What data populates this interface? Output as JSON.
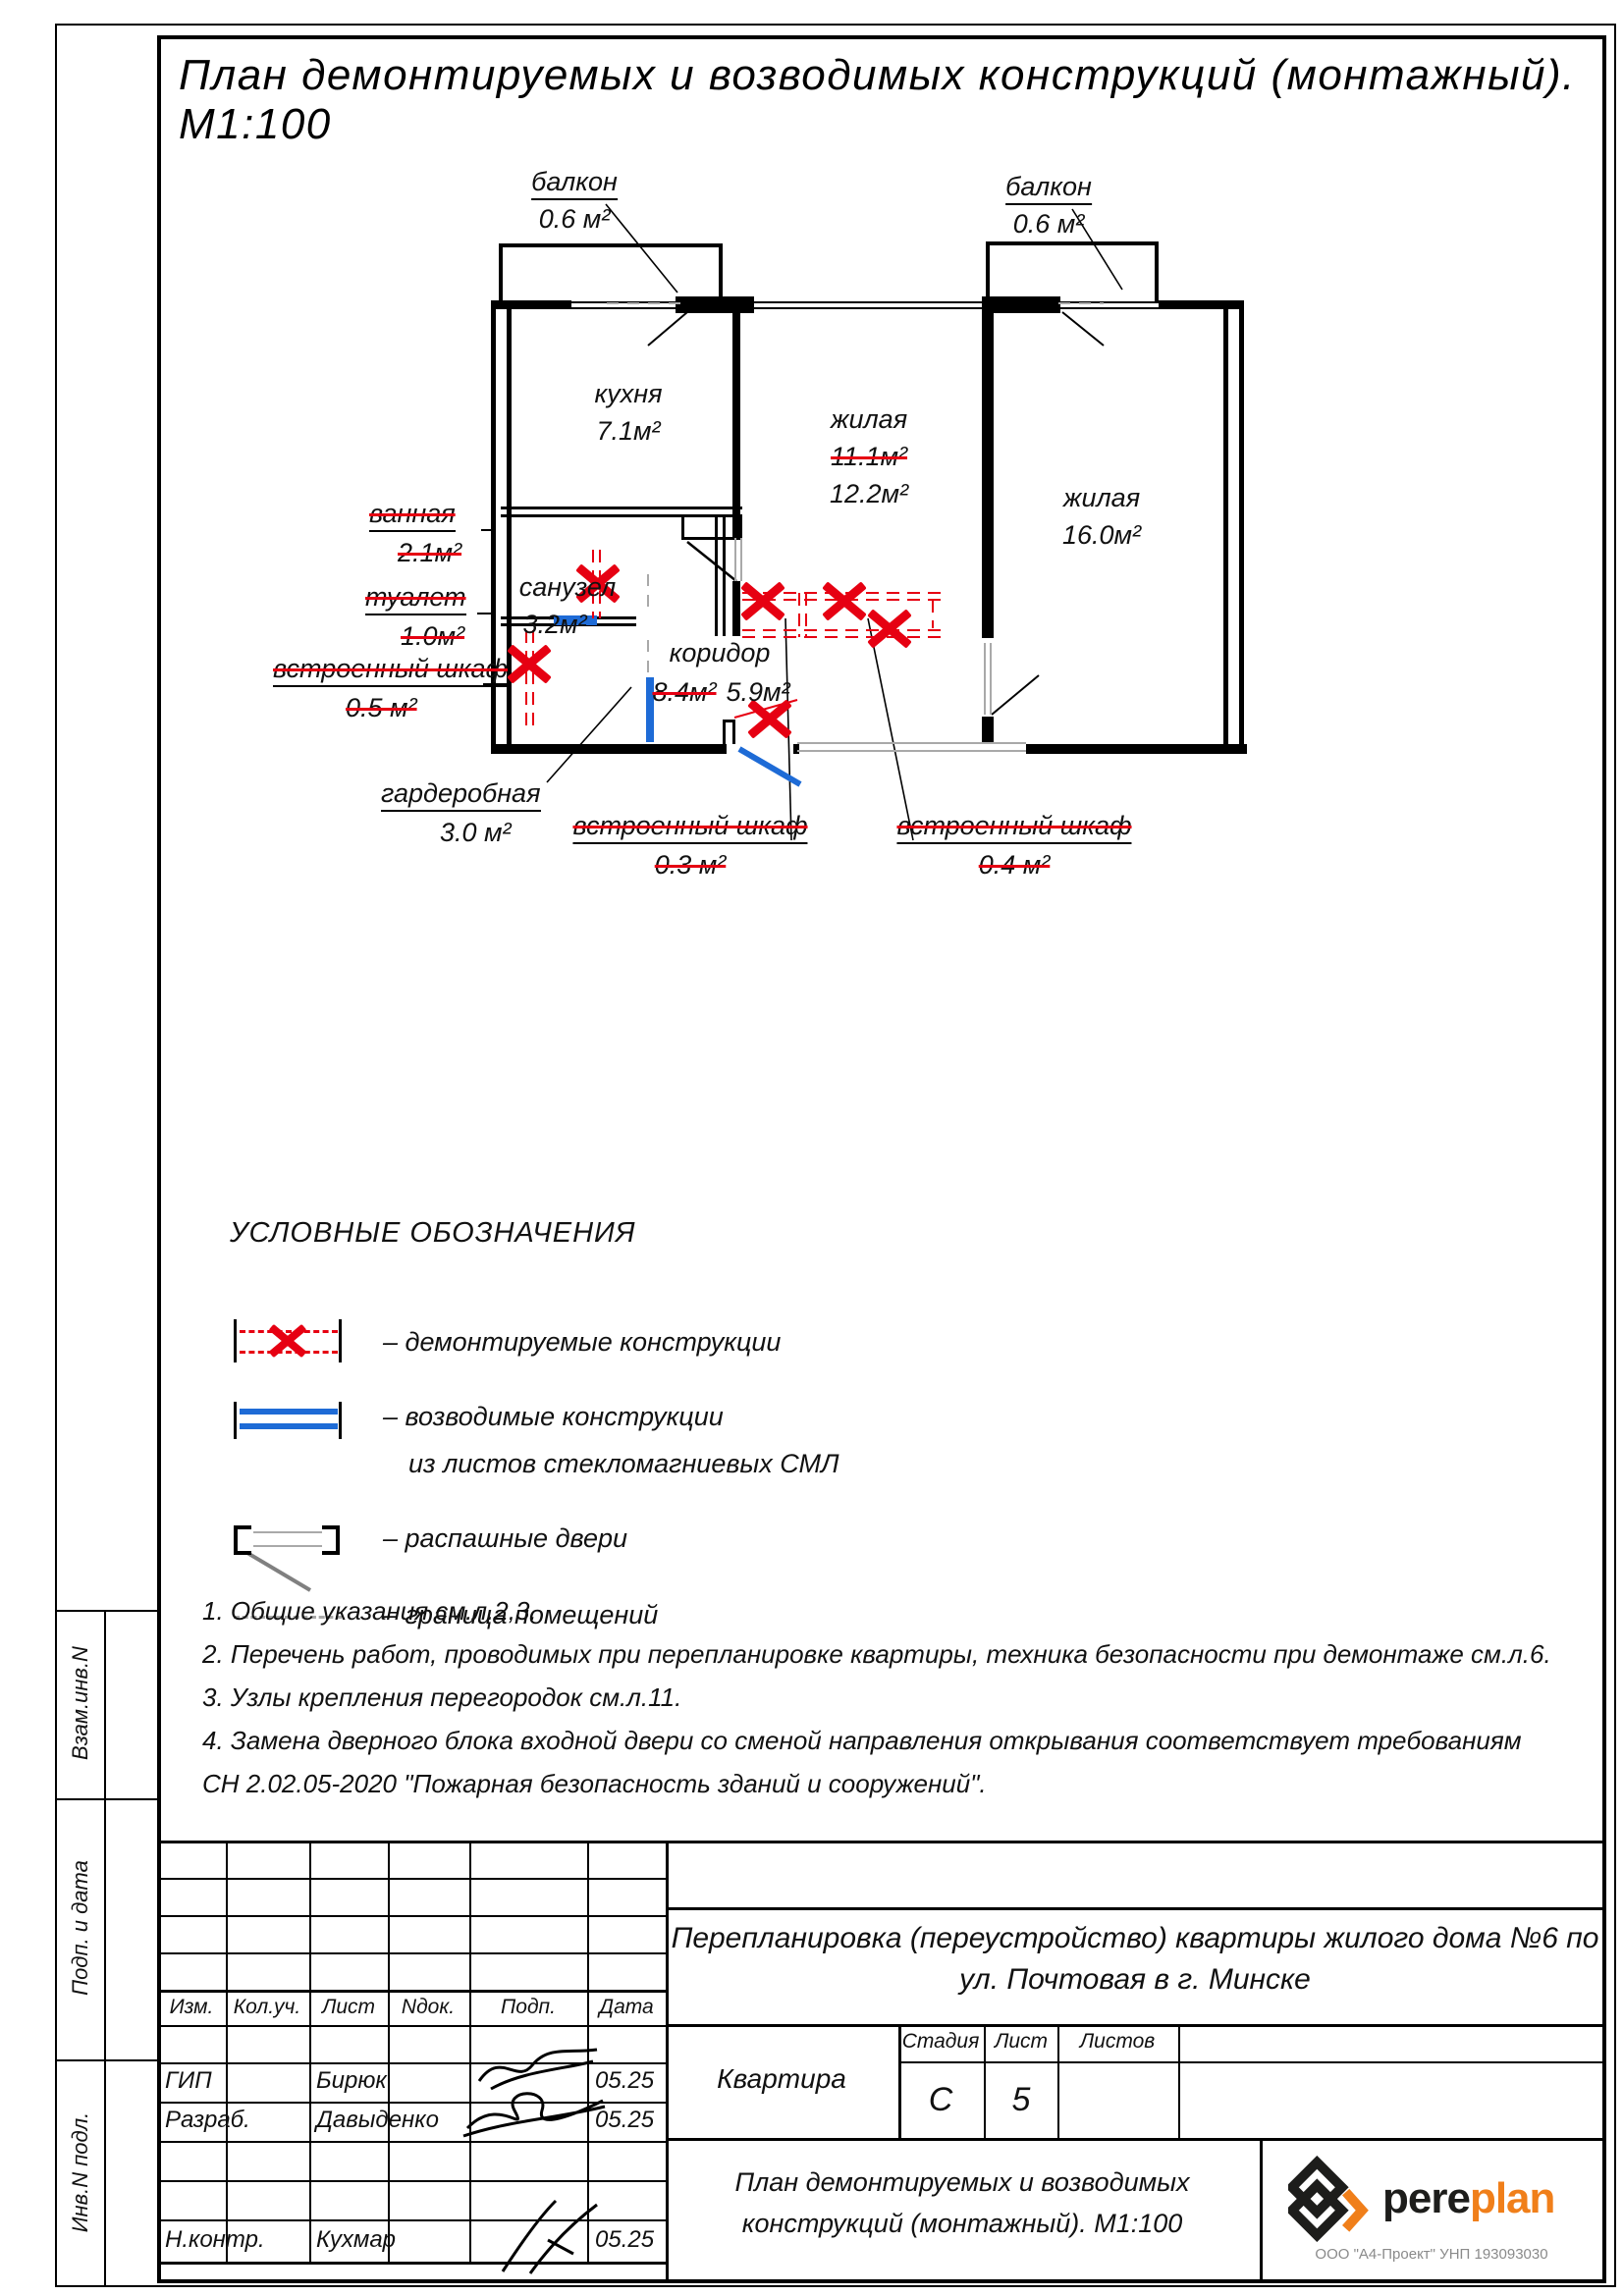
{
  "sheet": {
    "title": "План демонтируемых и возводимых конструкций (монтажный). М1:100"
  },
  "plan": {
    "balcony_left_name": "балкон",
    "balcony_left_area": "0.6 м²",
    "balcony_right_name": "балкон",
    "balcony_right_area": "0.6 м²",
    "kitchen_name": "кухня",
    "kitchen_area": "7.1м²",
    "living1_name": "жилая",
    "living1_area_old": "11.1м²",
    "living1_area_new": "12.2м²",
    "living2_name": "жилая",
    "living2_area": "16.0м²",
    "bathroom_name": "ванная",
    "bathroom_area": "2.1м²",
    "sanuzel_name": "санузел",
    "sanuzel_area": "3.2м²",
    "toilet_name": "туалет",
    "toilet_area": "1.0м²",
    "closet_left_name": "встроенный шкаф",
    "closet_left_area": "0.5 м²",
    "wardrobe_name": "гардеробная",
    "wardrobe_area": "3.0 м²",
    "corridor_name": "коридор",
    "corridor_area_old": "8.4м²",
    "corridor_area_new": "5.9м²",
    "closet1_name": "встроенный шкаф",
    "closet1_area": "0.3 м²",
    "closet2_name": "встроенный шкаф",
    "closet2_area": "0.4 м²"
  },
  "legend": {
    "heading": "УСЛОВНЫЕ ОБОЗНАЧЕНИЯ",
    "item1": "– демонтируемые конструкции",
    "item2a": "– возводимые конструкции",
    "item2b": "из листов стекломагниевых СМЛ",
    "item3": "– распашные двери",
    "item4": "– граница помещений"
  },
  "notes": {
    "n1": "1. Общие указания см.л.2,3.",
    "n2": "2. Перечень работ, проводимых при перепланировке квартиры, техника безопасности при демонтаже см.л.6.",
    "n3": "3. Узлы крепления перегородок см.л.11.",
    "n4": "4. Замена дверного блока входной двери со сменой направления открывания соответствует требованиям",
    "n5": "СН 2.02.05-2020 \"Пожарная безопасность зданий и сооружений\"."
  },
  "sidebar": {
    "box1": "Взам.инв.N",
    "box2": "Подп. и дата",
    "box3": "Инв.N подл."
  },
  "stamp": {
    "col_izm": "Изм.",
    "col_koluch": "Кол.уч.",
    "col_list": "Лист",
    "col_ndok": "Nдок.",
    "col_podp": "Подп.",
    "col_data": "Дата",
    "row1_role": "ГИП",
    "row1_name": "Бирюк",
    "row1_date": "05.25",
    "row2_role": "Разраб.",
    "row2_name": "Давыденко",
    "row2_date": "05.25",
    "row3_role": "Н.контр.",
    "row3_name": "Кухмар",
    "row3_date": "05.25",
    "project_line1": "Перепланировка (переустройство) квартиры жилого дома №6 по",
    "project_line2": "ул. Почтовая в г. Минске",
    "object": "Квартира",
    "stage_label": "Стадия",
    "sheet_label": "Лист",
    "sheets_label": "Листов",
    "stage_value": "С",
    "sheet_value": "5",
    "doc_title_line1": "План демонтируемых и возводимых",
    "doc_title_line2": "конструкций (монтажный). М1:100",
    "logo_part1": "pere",
    "logo_part2": "plan",
    "company": "ООО \"А4-Проект\" УНП 193093030"
  },
  "colors": {
    "demolition_red": "#e60012",
    "new_construction_blue": "#1e6bd6",
    "logo_orange": "#f07f1a"
  }
}
